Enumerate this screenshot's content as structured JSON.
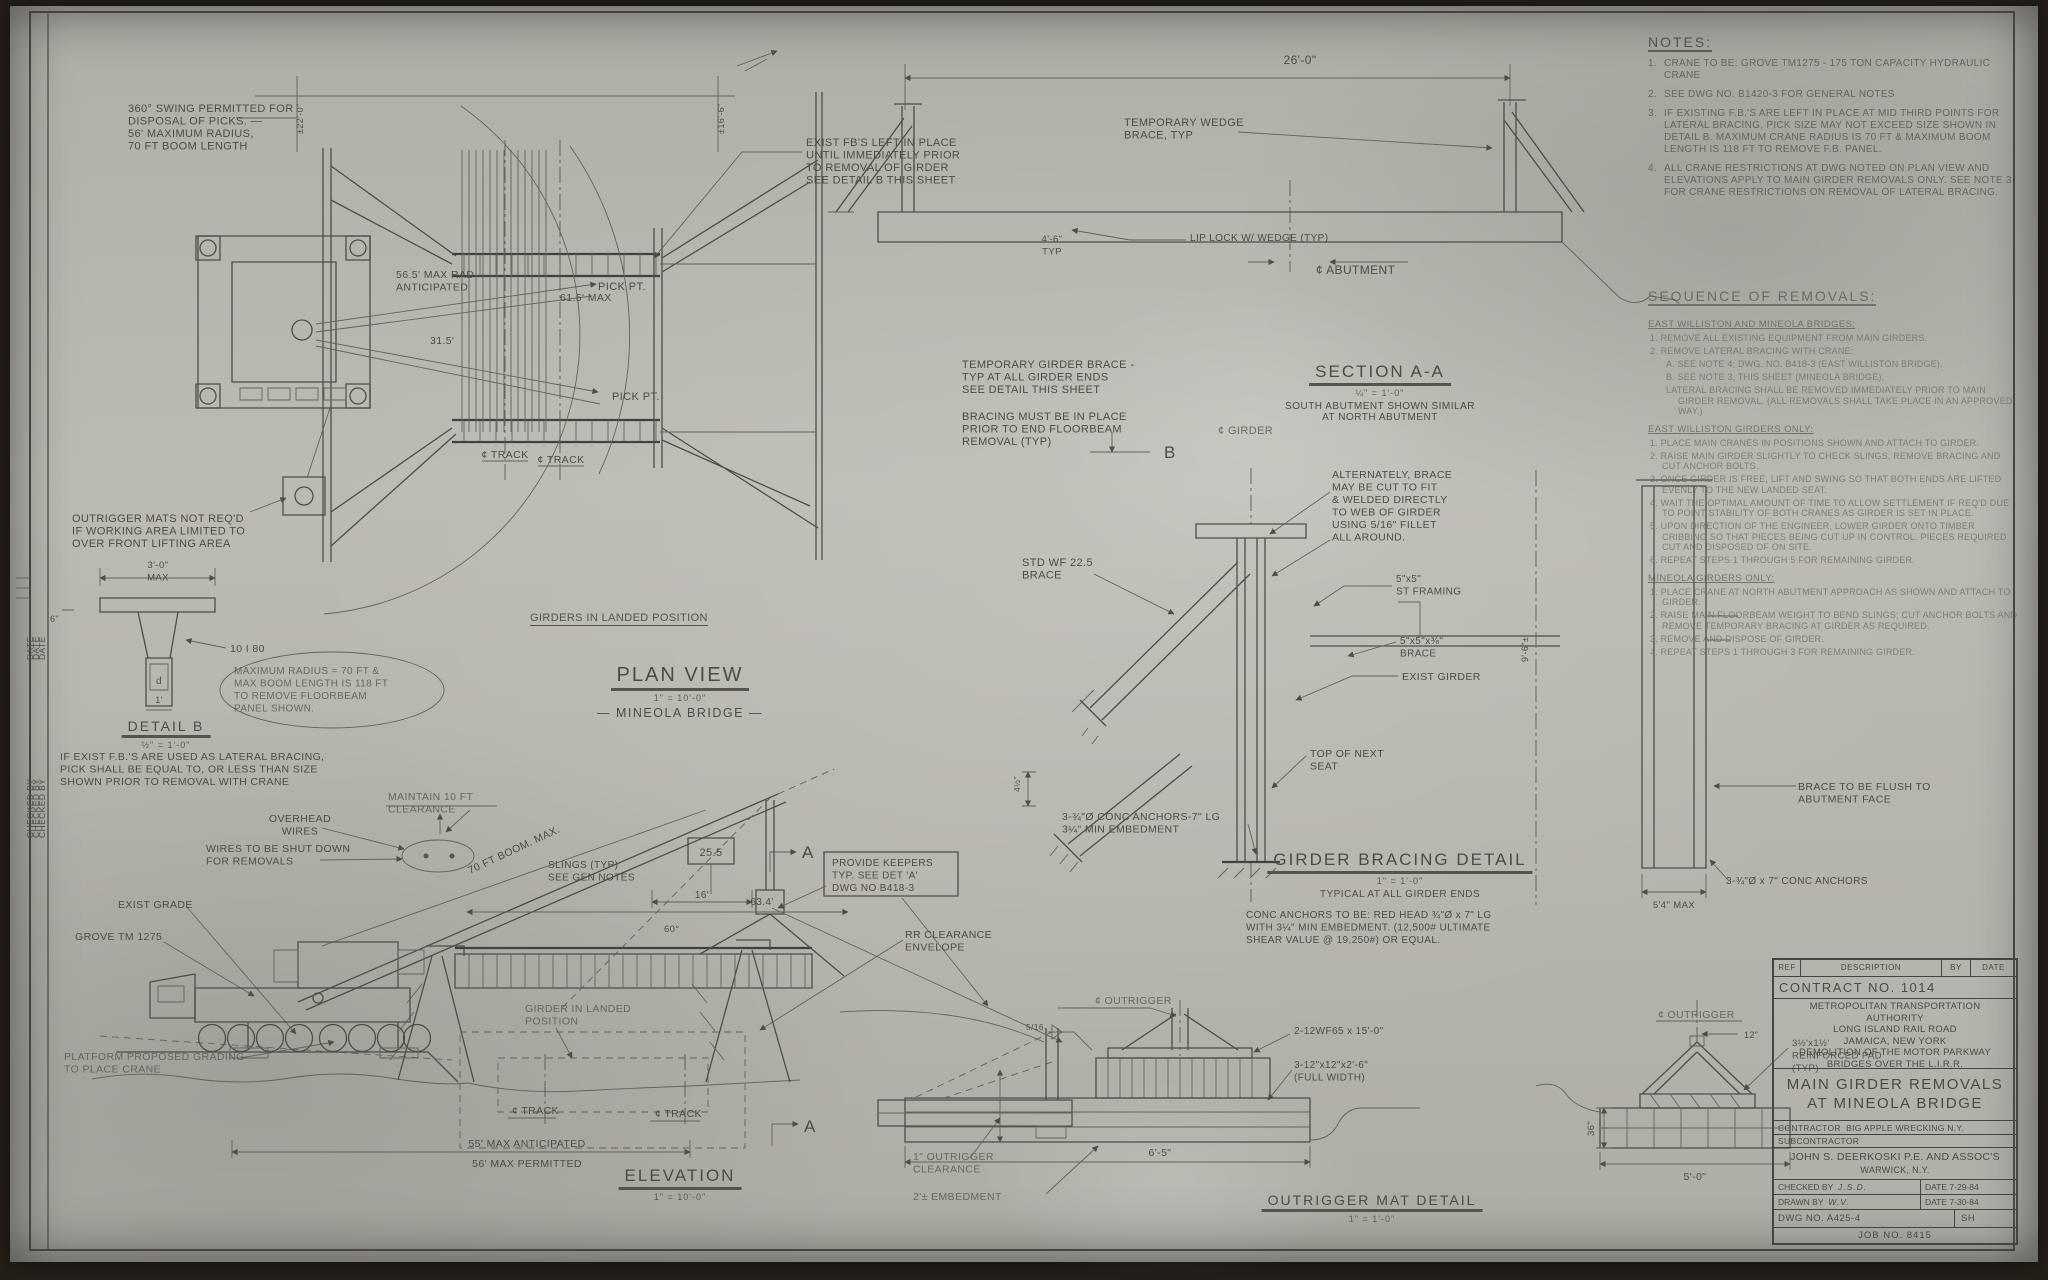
{
  "drawing_type": "engineering blueprint",
  "colors": {
    "paper": "#bcbbb3",
    "ink": "#4e4e47",
    "photo_background": "#241f18"
  },
  "notes": {
    "title": "NOTES:",
    "items": [
      {
        "n": "1.",
        "t": "CRANE TO BE: GROVE TM1275 - 175 TON CAPACITY HYDRAULIC CRANE"
      },
      {
        "n": "2.",
        "t": "SEE DWG NO. B1420-3 FOR GENERAL NOTES"
      },
      {
        "n": "3.",
        "t": "IF EXISTING F.B.'S ARE LEFT IN PLACE AT MID THIRD POINTS FOR LATERAL BRACING, PICK SIZE MAY NOT EXCEED SIZE SHOWN IN DETAIL B.  MAXIMUM CRANE RADIUS IS 70 FT & MAXIMUM BOOM LENGTH IS 118 FT TO REMOVE F.B. PANEL."
      },
      {
        "n": "4.",
        "t": "ALL CRANE RESTRICTIONS AT DWG NOTED ON PLAN VIEW AND ELEVATIONS APPLY TO MAIN GIRDER REMOVALS ONLY. SEE NOTE 3 FOR CRANE RESTRICTIONS ON REMOVAL OF LATERAL BRACING."
      }
    ]
  },
  "sequence": {
    "title": "SEQUENCE OF REMOVALS:",
    "sections": [
      {
        "heading": "EAST WILLISTON AND MINEOLA BRIDGES:",
        "items": [
          {
            "ind": 0,
            "t": "1. REMOVE ALL EXISTING EQUIPMENT FROM MAIN GIRDERS."
          },
          {
            "ind": 0,
            "t": "2. REMOVE LATERAL BRACING WITH CRANE:"
          },
          {
            "ind": 1,
            "t": "A. SEE NOTE 4; DWG. NO. B418-3 (EAST WILLISTON BRIDGE)."
          },
          {
            "ind": 1,
            "t": "B. SEE NOTE 3, THIS SHEET (MINEOLA BRIDGE)."
          },
          {
            "ind": 1,
            "t": "LATERAL BRACING SHALL BE REMOVED IMMEDIATELY PRIOR TO MAIN GIRDER REMOVAL. (ALL REMOVALS SHALL TAKE PLACE IN AN APPROVED WAY.)"
          }
        ]
      },
      {
        "heading": "EAST WILLISTON GIRDERS ONLY:",
        "items": [
          {
            "ind": 0,
            "t": "1. PLACE MAIN CRANES IN POSITIONS SHOWN AND ATTACH TO GIRDER."
          },
          {
            "ind": 0,
            "t": "2. RAISE MAIN GIRDER SLIGHTLY TO CHECK SLINGS, REMOVE BRACING AND CUT ANCHOR BOLTS."
          },
          {
            "ind": 0,
            "t": "3. ONCE GIRDER IS FREE, LIFT AND SWING SO THAT BOTH ENDS ARE LIFTED EVENLY TO THE NEW LANDED SEAT."
          },
          {
            "ind": 0,
            "t": "4. WAIT THE OPTIMAL AMOUNT OF TIME TO ALLOW SETTLEMENT IF REQ'D DUE TO POINT STABILITY OF BOTH CRANES AS GIRDER IS SET IN PLACE."
          },
          {
            "ind": 0,
            "t": "5. UPON DIRECTION OF THE ENGINEER, LOWER GIRDER ONTO TIMBER CRIBBING SO THAT PIECES BEING CUT UP IN CONTROL. PIECES REQUIRED CUT AND DISPOSED OF ON SITE."
          },
          {
            "ind": 0,
            "t": "6. REPEAT STEPS 1 THROUGH 5 FOR REMAINING GIRDER."
          }
        ]
      },
      {
        "heading": "MINEOLA GIRDERS ONLY:",
        "items": [
          {
            "ind": 0,
            "t": "1. PLACE CRANE AT NORTH ABUTMENT APPROACH AS SHOWN AND ATTACH TO GIRDER."
          },
          {
            "ind": 0,
            "t": "2. RAISE MAIN FLOORBEAM WEIGHT TO BEND SLINGS; CUT ANCHOR BOLTS AND REMOVE TEMPORARY BRACING AT GIRDER AS REQUIRED."
          },
          {
            "ind": 0,
            "t": "3. REMOVE AND DISPOSE OF GIRDER."
          },
          {
            "ind": 0,
            "t": "4. REPEAT STEPS 1 THROUGH 3 FOR REMAINING GIRDER."
          }
        ]
      }
    ]
  },
  "view_titles": {
    "plan": {
      "pre": "GIRDERS IN LANDED POSITION",
      "name": "PLAN VIEW",
      "scale": "1\" = 10'-0\"",
      "sub": "— MINEOLA BRIDGE —"
    },
    "section": {
      "name": "SECTION A-A",
      "scale": "¼\" = 1'-0\"",
      "sub1": "SOUTH ABUTMENT SHOWN SIMILAR",
      "sub2": "AT NORTH ABUTMENT"
    },
    "bracing": {
      "name": "GIRDER BRACING DETAIL",
      "scale": "1\" = 1'-0\"",
      "sub1": "TYPICAL AT ALL GIRDER ENDS"
    },
    "elevation": {
      "name": "ELEVATION",
      "scale": "1\" = 10'-0\""
    },
    "outrigger": {
      "name": "OUTRIGGER MAT DETAIL",
      "scale": "1\" = 1'-0\""
    },
    "detailb": {
      "name": "DETAIL B",
      "scale": "½\" = 1'-0\""
    }
  },
  "title_block": {
    "rev": {
      "ref": "REF",
      "desc": "DESCRIPTION",
      "by": "BY",
      "date": "DATE"
    },
    "contract": "CONTRACT NO. 1014",
    "agency": [
      "METROPOLITAN TRANSPORTATION",
      "AUTHORITY",
      "LONG ISLAND RAIL ROAD",
      "JAMAICA, NEW YORK",
      "DEMOLITION OF THE MOTOR PARKWAY",
      "BRIDGES OVER THE L.I.R.R."
    ],
    "title1": "MAIN GIRDER REMOVALS",
    "title2": "AT MINEOLA BRIDGE",
    "contractor_label": "CONTRACTOR",
    "contractor": "BIG APPLE WRECKING N.Y.",
    "subcontractor_label": "SUBCONTRACTOR",
    "engineer": "JOHN S. DEERKOSKI P.E. AND ASSOC'S",
    "engineer_city": "WARWICK, N.Y.",
    "checked_label": "CHECKED BY",
    "checked": "J.S.D.",
    "checked_date": "DATE 7-29-84",
    "drawn_label": "DRAWN BY",
    "drawn": "W.V.",
    "drawn_date": "DATE 7-30-84",
    "dwg": "DWG NO. A425-4",
    "sh": "SH",
    "job": "JOB NO. 8415"
  },
  "labels": [
    {
      "x": 128,
      "y": 112,
      "t": [
        "360° SWING PERMITTED FOR",
        "DISPOSAL OF PICKS. —",
        "56' MAXIMUM RADIUS,",
        "70 FT BOOM LENGTH"
      ],
      "s": 11
    },
    {
      "x": 303,
      "y": 134,
      "t": "±22'-0\"",
      "s": 9,
      "r": -90
    },
    {
      "x": 724,
      "y": 134,
      "t": "±16'-6\"",
      "s": 9,
      "r": -90
    },
    {
      "x": 806,
      "y": 146,
      "t": [
        "EXIST FB'S LEFT IN PLACE",
        "UNTIL IMMEDIATELY PRIOR",
        "TO REMOVAL OF GIRDER",
        "SEE DETAIL B THIS SHEET"
      ],
      "s": 11
    },
    {
      "x": 598,
      "y": 290,
      "t": "PICK PT.",
      "s": 11
    },
    {
      "x": 396,
      "y": 278,
      "t": [
        "56.5' MAX RAD",
        "ANTICIPATED"
      ],
      "s": 10.5
    },
    {
      "x": 560,
      "y": 301,
      "t": "61.5' MAX",
      "s": 10.5
    },
    {
      "x": 430,
      "y": 344,
      "t": "31.5'",
      "s": 10.5
    },
    {
      "x": 612,
      "y": 400,
      "t": "PICK PT.",
      "s": 11
    },
    {
      "x": 505,
      "y": 458,
      "t": "¢ TRACK",
      "s": 10.5,
      "a": "middle"
    },
    {
      "x": 561,
      "y": 463,
      "t": "¢ TRACK",
      "s": 10.5,
      "a": "middle"
    },
    {
      "x": 962,
      "y": 368,
      "t": [
        "TEMPORARY GIRDER BRACE -",
        "TYP AT ALL GIRDER ENDS",
        "SEE DETAIL THIS SHEET"
      ],
      "s": 11
    },
    {
      "x": 962,
      "y": 420,
      "t": [
        "BRACING MUST BE IN PLACE",
        "PRIOR TO END FLOORBEAM",
        "REMOVAL (TYP)"
      ],
      "s": 11
    },
    {
      "x": 1164,
      "y": 458,
      "t": "B",
      "s": 17
    },
    {
      "x": 1300,
      "y": 64,
      "t": "26'-0\"",
      "s": 12,
      "a": "middle"
    },
    {
      "x": 1124,
      "y": 126,
      "t": [
        "TEMPORARY WEDGE",
        "BRACE, TYP"
      ],
      "s": 11
    },
    {
      "x": 1052,
      "y": 242,
      "t": [
        "4'-6\"",
        "TYP"
      ],
      "s": 9.5,
      "a": "middle"
    },
    {
      "x": 1190,
      "y": 241,
      "t": "LIP LOCK W/ WEDGE (TYP)",
      "s": 10
    },
    {
      "x": 1316,
      "y": 274,
      "t": "¢ ABUTMENT",
      "s": 12
    },
    {
      "x": 1218,
      "y": 434,
      "t": "¢ GIRDER",
      "s": 11,
      "cls": "pencil"
    },
    {
      "x": 1332,
      "y": 478,
      "t": [
        "ALTERNATELY, BRACE",
        "MAY BE CUT TO FIT",
        "& WELDED DIRECTLY",
        "TO WEB OF GIRDER",
        "USING 5/16\" FILLET",
        "ALL AROUND."
      ],
      "s": 10.5
    },
    {
      "x": 1022,
      "y": 566,
      "t": [
        "STD WF 22.5",
        "BRACE"
      ],
      "s": 11
    },
    {
      "x": 1396,
      "y": 582,
      "t": [
        "5\"x5\"",
        "ST FRAMING"
      ],
      "s": 10
    },
    {
      "x": 1400,
      "y": 644,
      "t": [
        "5\"x5\"x⅜\"",
        "BRACE"
      ],
      "s": 10
    },
    {
      "x": 1402,
      "y": 680,
      "t": "EXIST GIRDER",
      "s": 10.5
    },
    {
      "x": 1310,
      "y": 757,
      "t": [
        "TOP OF NEXT",
        "SEAT"
      ],
      "s": 10.5
    },
    {
      "x": 1020,
      "y": 792,
      "t": "4½\"",
      "s": 8.5,
      "r": -90
    },
    {
      "x": 1062,
      "y": 820,
      "t": [
        "3-¾\"Ø CONC ANCHORS-7\" LG",
        "3¼\" MIN EMBEDMENT"
      ],
      "s": 10.5
    },
    {
      "x": 1246,
      "y": 918,
      "t": [
        "CONC ANCHORS TO BE: RED HEAD ¾\"Ø x 7\" LG",
        "WITH 3¼\" MIN EMBEDMENT. (12,500# ULTIMATE",
        "SHEAR VALUE @ 19,250#) OR EQUAL."
      ],
      "s": 10
    },
    {
      "x": 1798,
      "y": 790,
      "t": [
        "BRACE TO BE FLUSH TO",
        "ABUTMENT FACE"
      ],
      "s": 10.5
    },
    {
      "x": 1726,
      "y": 884,
      "t": "3-¾\"Ø x 7\" CONC ANCHORS",
      "s": 10
    },
    {
      "x": 1674,
      "y": 908,
      "t": "5'4\" MAX",
      "s": 9.5,
      "a": "middle"
    },
    {
      "x": 1528,
      "y": 662,
      "t": "9'-6\"±",
      "s": 9,
      "r": -90
    },
    {
      "x": 72,
      "y": 522,
      "t": [
        "OUTRIGGER MATS NOT REQ'D",
        "IF WORKING AREA LIMITED TO",
        "OVER FRONT LIFTING AREA"
      ],
      "s": 11
    },
    {
      "x": 158,
      "y": 568,
      "t": [
        "3'-0\"",
        "MAX"
      ],
      "s": 9.5,
      "a": "middle"
    },
    {
      "x": 50,
      "y": 622,
      "t": "6\"",
      "s": 9
    },
    {
      "x": 230,
      "y": 652,
      "t": "10 I 80",
      "s": 10.5
    },
    {
      "x": 159,
      "y": 684,
      "t": "d",
      "s": 10,
      "a": "middle"
    },
    {
      "x": 159,
      "y": 703,
      "t": "1'",
      "s": 9,
      "a": "middle"
    },
    {
      "x": 234,
      "y": 674,
      "t": [
        "MAXIMUM RADIUS = 70 FT &",
        "MAX BOOM LENGTH IS 118 FT",
        "TO REMOVE FLOORBEAM",
        "PANEL SHOWN."
      ],
      "s": 10,
      "cls": "pencil"
    },
    {
      "x": 60,
      "y": 760,
      "t": [
        "IF EXIST F.B.'S ARE USED AS LATERAL BRACING,",
        "PICK SHALL BE EQUAL TO, OR LESS THAN SIZE",
        "SHOWN PRIOR TO REMOVAL WITH CRANE"
      ],
      "s": 10.5
    },
    {
      "x": 388,
      "y": 800,
      "t": [
        "MAINTAIN 10 FT",
        "CLEARANCE"
      ],
      "s": 10.5,
      "cls": "pencil"
    },
    {
      "x": 300,
      "y": 822,
      "t": [
        "OVERHEAD",
        "WIRES"
      ],
      "s": 10.5,
      "a": "middle"
    },
    {
      "x": 206,
      "y": 852,
      "t": [
        "WIRES TO BE SHUT DOWN",
        "FOR REMOVALS"
      ],
      "s": 10.5
    },
    {
      "x": 118,
      "y": 908,
      "t": "EXIST GRADE",
      "s": 10.5
    },
    {
      "x": 75,
      "y": 940,
      "t": "GROVE TM 1275",
      "s": 10.5
    },
    {
      "x": 470,
      "y": 874,
      "t": "70 FT BOOM. MAX.",
      "s": 10.5,
      "r": -25
    },
    {
      "x": 64,
      "y": 1060,
      "t": [
        "PLATFORM PROPOSED GRADING",
        "TO PLACE CRANE"
      ],
      "s": 10.5,
      "cls": "pencil"
    },
    {
      "x": 548,
      "y": 868,
      "t": [
        "SLINGS (TYP)",
        "SEE GEN NOTES"
      ],
      "s": 10
    },
    {
      "x": 711,
      "y": 856,
      "t": "25.5",
      "s": 11,
      "a": "middle"
    },
    {
      "x": 702,
      "y": 898,
      "t": "16'",
      "s": 10,
      "a": "middle"
    },
    {
      "x": 762,
      "y": 905,
      "t": "63.4'",
      "s": 10,
      "a": "middle"
    },
    {
      "x": 664,
      "y": 932,
      "t": "60°",
      "s": 9.5
    },
    {
      "x": 832,
      "y": 866,
      "t": [
        "PROVIDE KEEPERS",
        "TYP. SEE DET 'A'",
        "DWG NO B418-3"
      ],
      "s": 10
    },
    {
      "x": 905,
      "y": 938,
      "t": [
        "RR CLEARANCE",
        "ENVELOPE"
      ],
      "s": 10.5
    },
    {
      "x": 525,
      "y": 1012,
      "t": [
        "GIRDER IN LANDED",
        "POSITION"
      ],
      "s": 10.5,
      "cls": "pencil"
    },
    {
      "x": 512,
      "y": 1114,
      "t": "¢ TRACK",
      "s": 10.5
    },
    {
      "x": 655,
      "y": 1117,
      "t": "¢ TRACK",
      "s": 10.5
    },
    {
      "x": 802,
      "y": 858,
      "t": "A",
      "s": 17
    },
    {
      "x": 804,
      "y": 1132,
      "t": "A",
      "s": 17
    },
    {
      "x": 527,
      "y": 1147,
      "t": "55' MAX ANTICIPATED",
      "s": 10.5,
      "a": "middle"
    },
    {
      "x": 527,
      "y": 1167,
      "t": "56' MAX PERMITTED",
      "s": 10.5,
      "a": "middle"
    },
    {
      "x": 1095,
      "y": 1004,
      "t": "¢ OUTRIGGER",
      "s": 10.5,
      "cls": "pencil"
    },
    {
      "x": 1044,
      "y": 1030,
      "t": "5/16",
      "s": 8.5,
      "a": "end"
    },
    {
      "x": 1294,
      "y": 1034,
      "t": "2-12WF65 x 15'-0\"",
      "s": 10
    },
    {
      "x": 1294,
      "y": 1068,
      "t": [
        "3-12\"x12\"x2'-6\"",
        "(FULL WIDTH)"
      ],
      "s": 10
    },
    {
      "x": 913,
      "y": 1160,
      "t": [
        "1\" OUTRIGGER",
        "CLEARANCE"
      ],
      "s": 10.5,
      "cls": "pencil"
    },
    {
      "x": 913,
      "y": 1200,
      "t": "2'± EMBEDMENT",
      "s": 10.5,
      "cls": "pencil"
    },
    {
      "x": 1160,
      "y": 1156,
      "t": "6'-5\"",
      "s": 10.5,
      "a": "middle"
    },
    {
      "x": 1658,
      "y": 1018,
      "t": "¢ OUTRIGGER",
      "s": 10.5,
      "cls": "pencil"
    },
    {
      "x": 1744,
      "y": 1038,
      "t": "12\"",
      "s": 9
    },
    {
      "x": 1792,
      "y": 1046,
      "t": [
        "3½'x1½'",
        "REINFORCED PAD",
        "(TYP)"
      ],
      "s": 9.5
    },
    {
      "x": 1594,
      "y": 1136,
      "t": "36\"",
      "s": 9.5,
      "r": -90
    },
    {
      "x": 1695,
      "y": 1180,
      "t": "5'-0\"",
      "s": 10.5,
      "a": "middle"
    },
    {
      "x": 33,
      "y": 660,
      "t": "DATE",
      "s": 8.5,
      "r": -90
    },
    {
      "x": 39,
      "y": 660,
      "t": "DATE",
      "s": 8.5,
      "r": -90
    },
    {
      "x": 45,
      "y": 660,
      "t": "DATE",
      "s": 8.5,
      "r": -90
    },
    {
      "x": 33,
      "y": 838,
      "t": "CHECKED BY",
      "s": 8.5,
      "r": -90
    },
    {
      "x": 39,
      "y": 838,
      "t": "CHECKED BY",
      "s": 8.5,
      "r": -90
    },
    {
      "x": 45,
      "y": 838,
      "t": "CHECKED BY",
      "s": 8.5,
      "r": -90
    }
  ]
}
